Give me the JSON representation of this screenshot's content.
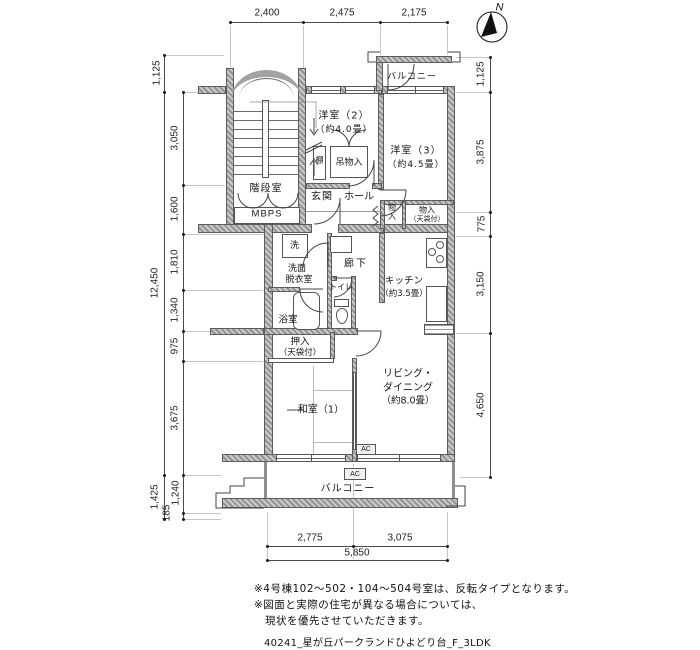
{
  "compass": {
    "north": "N"
  },
  "dims": {
    "top": [
      "2,400",
      "2,475",
      "2,175"
    ],
    "left_outer": [
      "1,125",
      "12,450",
      "1,425"
    ],
    "left_inner": [
      "3,050",
      "1,600",
      "1,810",
      "1,340",
      "975",
      "3,675",
      "1,240",
      "185"
    ],
    "right": [
      "1,125",
      "3,875",
      "775",
      "3,150",
      "4,650"
    ],
    "bottom": [
      "2,775",
      "3,075"
    ],
    "bottom_total": "5,850"
  },
  "rooms": {
    "stairwell": "階段室",
    "mbps": "MBPS",
    "entrance": "玄関",
    "hall": "ホール",
    "west2": "洋室（2）",
    "west2_size": "（約4.0畳）",
    "west3": "洋室（3）",
    "west3_size": "（約4.5畳）",
    "balcony_top": "バルコニー",
    "balcony_bottom": "バルコニー",
    "shelf": "棚",
    "hanging_closet": "吊物入",
    "closet_stack": "物\n入",
    "closet": "物入",
    "closet_note": "（天袋付）",
    "washer": "洗",
    "washroom_1": "洗面",
    "washroom_2": "脱衣室",
    "corridor": "廊下",
    "kitchen": "キッチン",
    "kitchen_size": "（約3.5畳）",
    "toilet": "トイレ",
    "bath": "浴室",
    "oshiire": "押入",
    "oshiire_note": "（天袋付）",
    "japanese1": "和室（1）",
    "living_1": "リビング・",
    "living_2": "ダイニング",
    "living_size": "（約8.0畳）",
    "ac": "AC"
  },
  "notes": [
    "※4号棟102～502・104～504号室は、反転タイプとなります。",
    "※図面と実際の住宅が異なる場合については、",
    "　現状を優先させていただきます。"
  ],
  "footer": "40241_星が丘パークランドひよどり台_F_3LDK"
}
